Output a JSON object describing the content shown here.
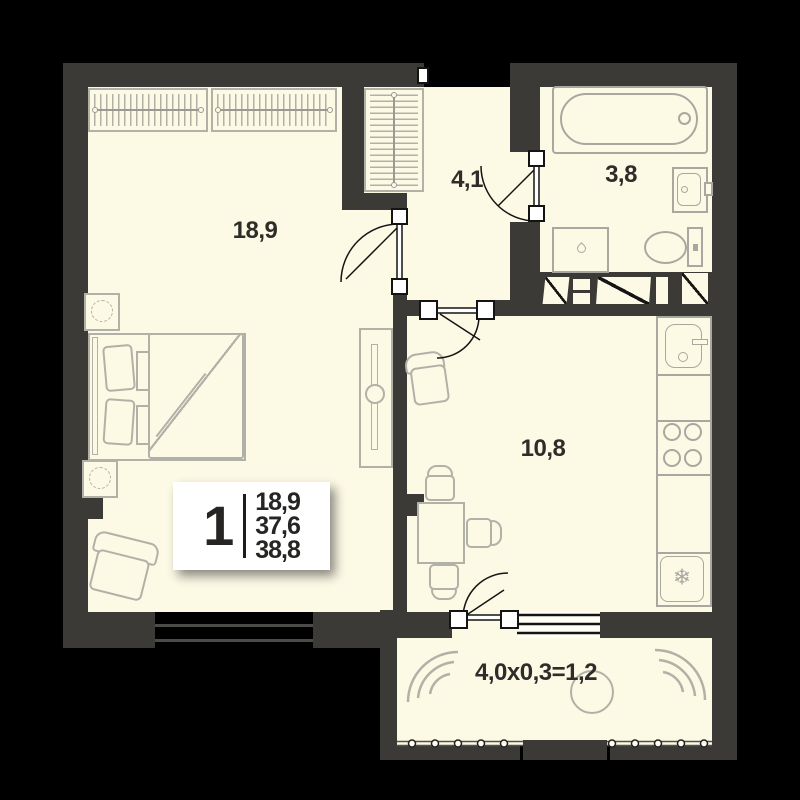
{
  "plan": {
    "info_box": {
      "rooms_count": "1",
      "living_area": "18,9",
      "apartment_area": "37,6",
      "total_area": "38,8"
    },
    "room_labels": {
      "bedroom": "18,9",
      "hallway": "4,1",
      "bathroom": "3,8",
      "kitchen": "10,8",
      "balcony": "4,0x0,3=1,2"
    },
    "icons": {
      "fridge_snowflake": "❄"
    },
    "colors": {
      "background": "#000000",
      "wall": "#3b3a37",
      "floor": "#fcf9e5",
      "furniture_line": "#b2b1a8",
      "fixture_line": "#a9a8a0",
      "door_line": "#141414",
      "label_text": "#2e2d2a"
    }
  }
}
